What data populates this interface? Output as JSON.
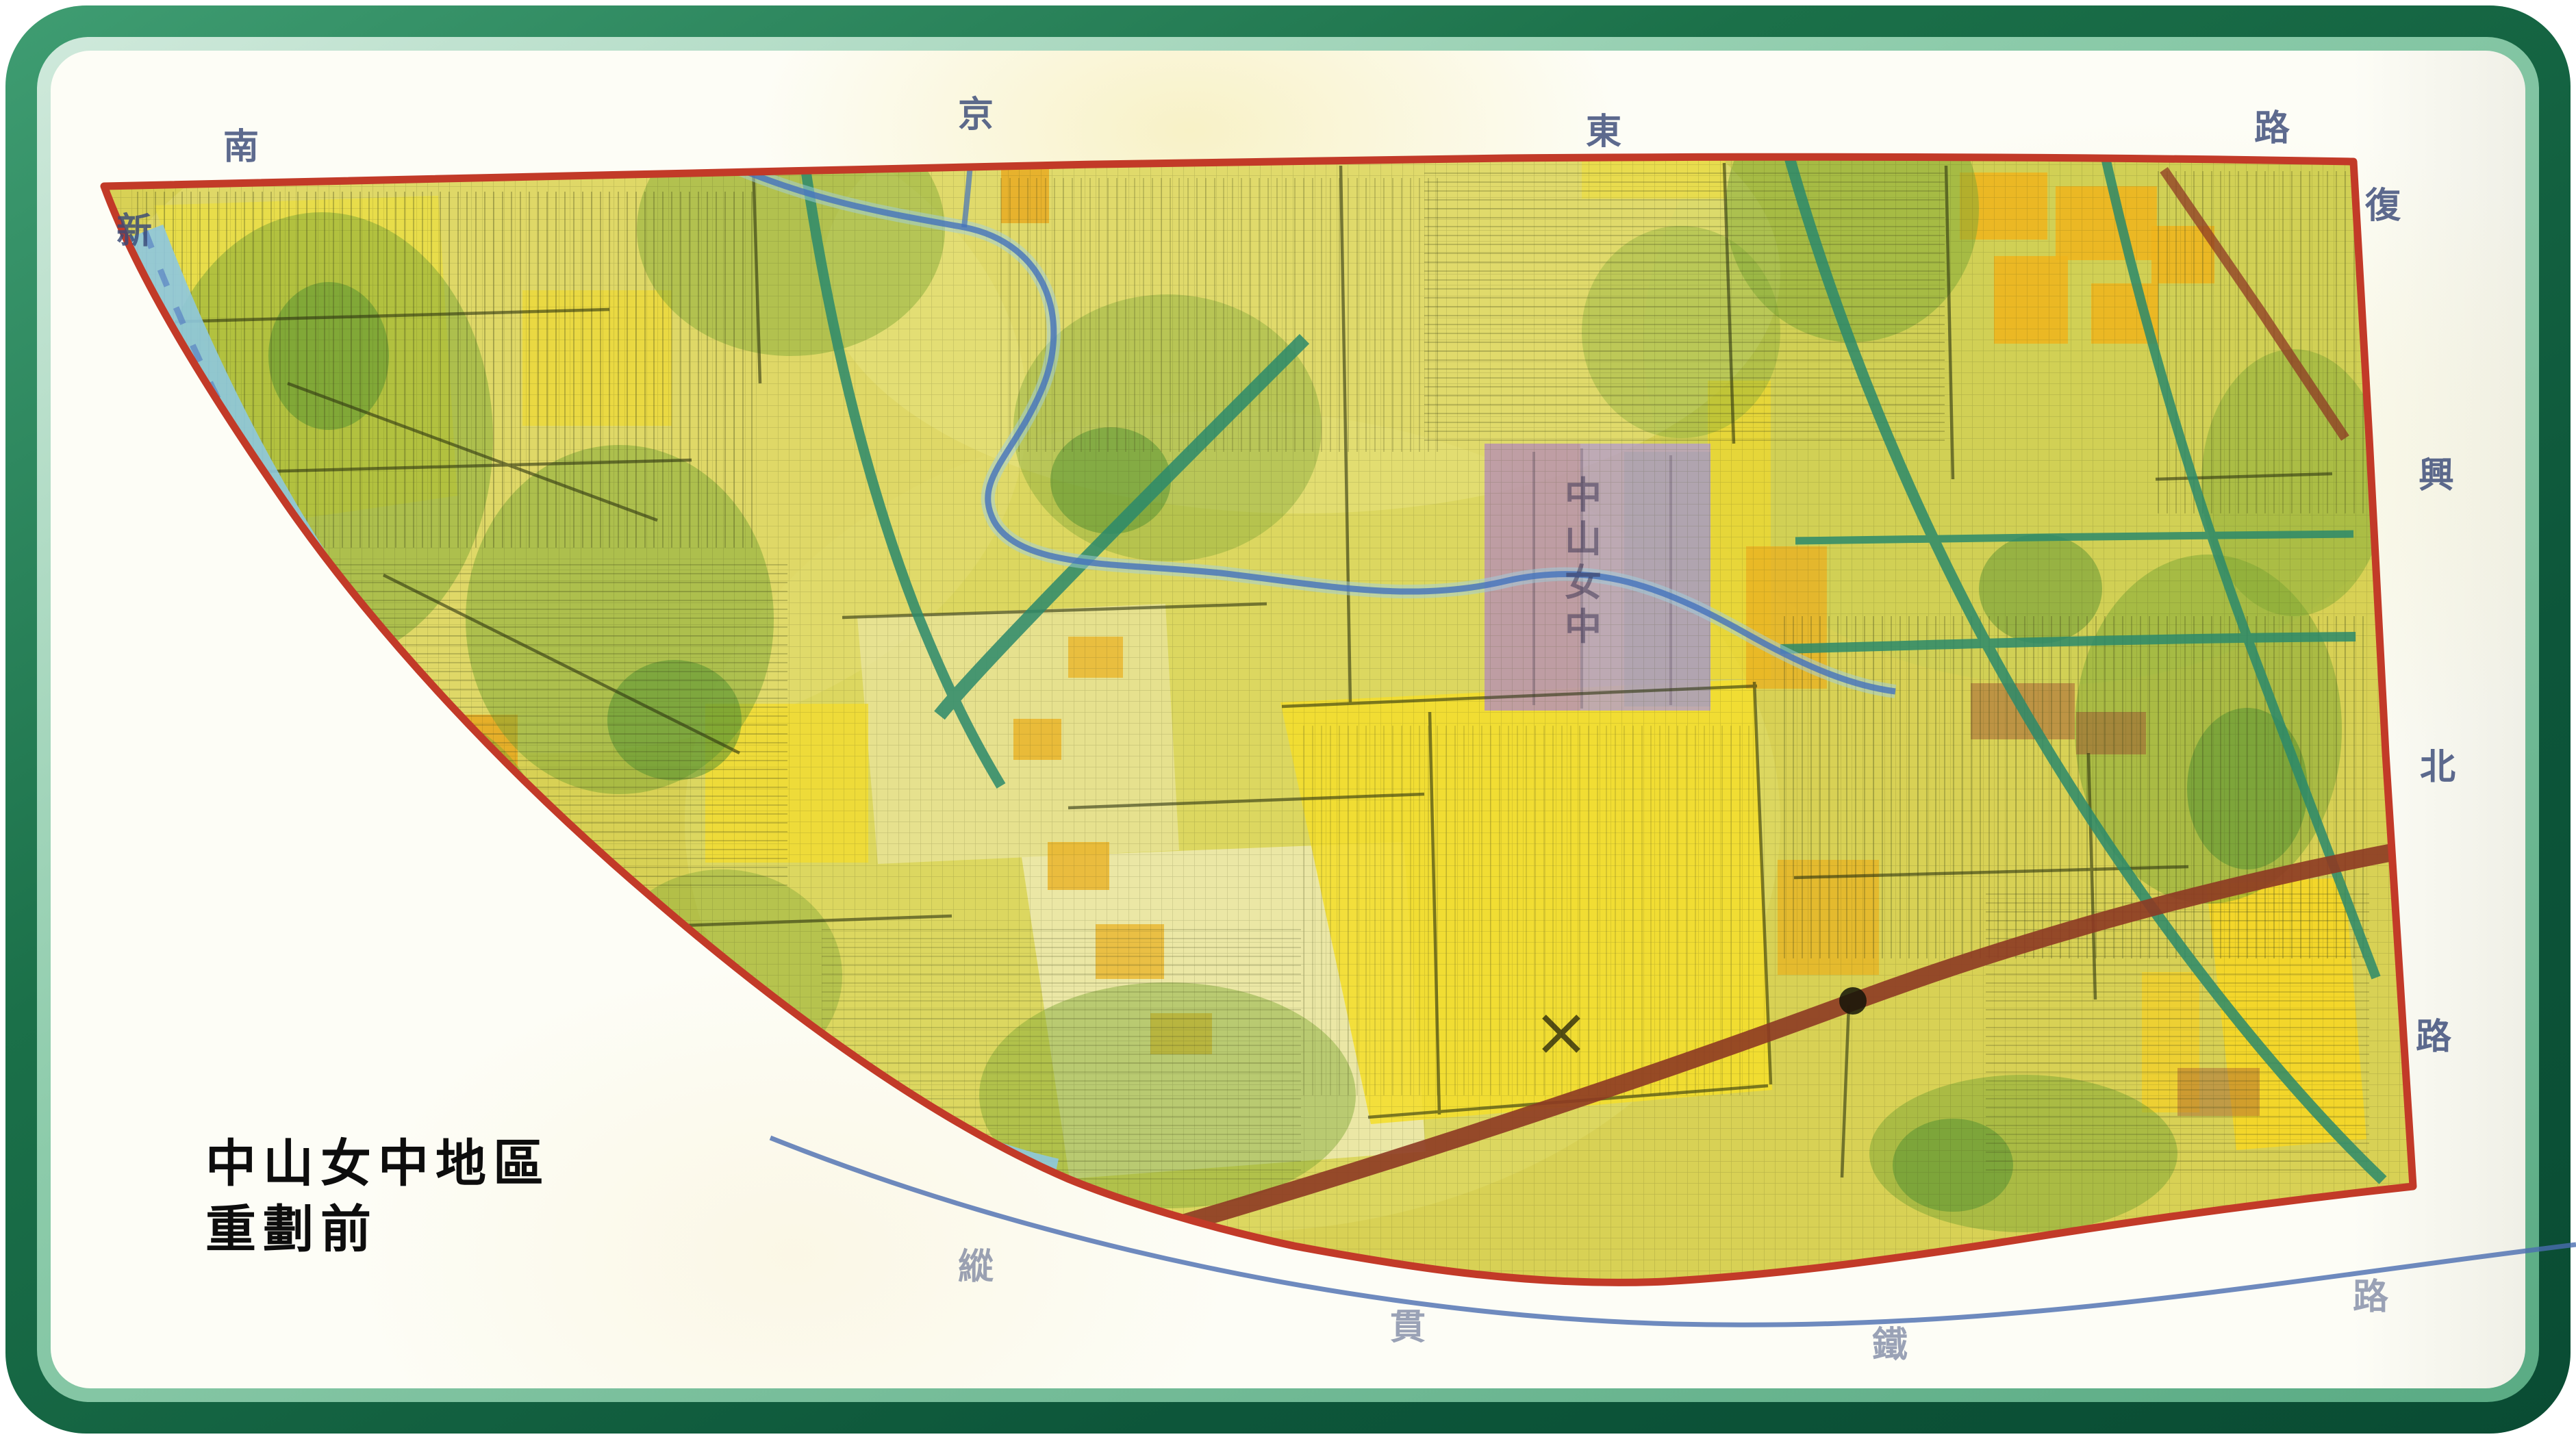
{
  "page": {
    "frame_outer_color": "#0d563a",
    "frame_inner_color": "#8ccbaa",
    "paper_color": "#fdfdf6"
  },
  "map": {
    "title_line1": "中山女中地區",
    "title_line2": "重劃前",
    "school_label": "中山女中",
    "school_label_chars": [
      "中",
      "山",
      "女",
      "中"
    ],
    "edge_labels": {
      "top": [
        {
          "char": "南"
        },
        {
          "char": "京"
        },
        {
          "char": "東"
        },
        {
          "char": "路"
        }
      ],
      "left": [
        {
          "char": "新"
        }
      ],
      "right": [
        {
          "char": "復"
        },
        {
          "char": "興"
        },
        {
          "char": "北"
        },
        {
          "char": "路"
        }
      ],
      "bottom": [
        {
          "char": "縱"
        },
        {
          "char": "貫"
        },
        {
          "char": "鐵"
        },
        {
          "char": "路"
        }
      ]
    },
    "colors": {
      "boundary": "#c23a28",
      "river": "#8ec8de",
      "stream": "#4472bc",
      "railway": "#4a6db0",
      "road_brown": "#8d3a24",
      "road_green": "#2c8a6b",
      "base": "#d8d155",
      "bright_yellow": "#f4de2c",
      "orange": "#eca81e",
      "green_patch": "#7ca634",
      "school_block": "#b7a1c2",
      "label_ink": "#3a4a78",
      "title_ink": "#0d0d0d"
    }
  }
}
